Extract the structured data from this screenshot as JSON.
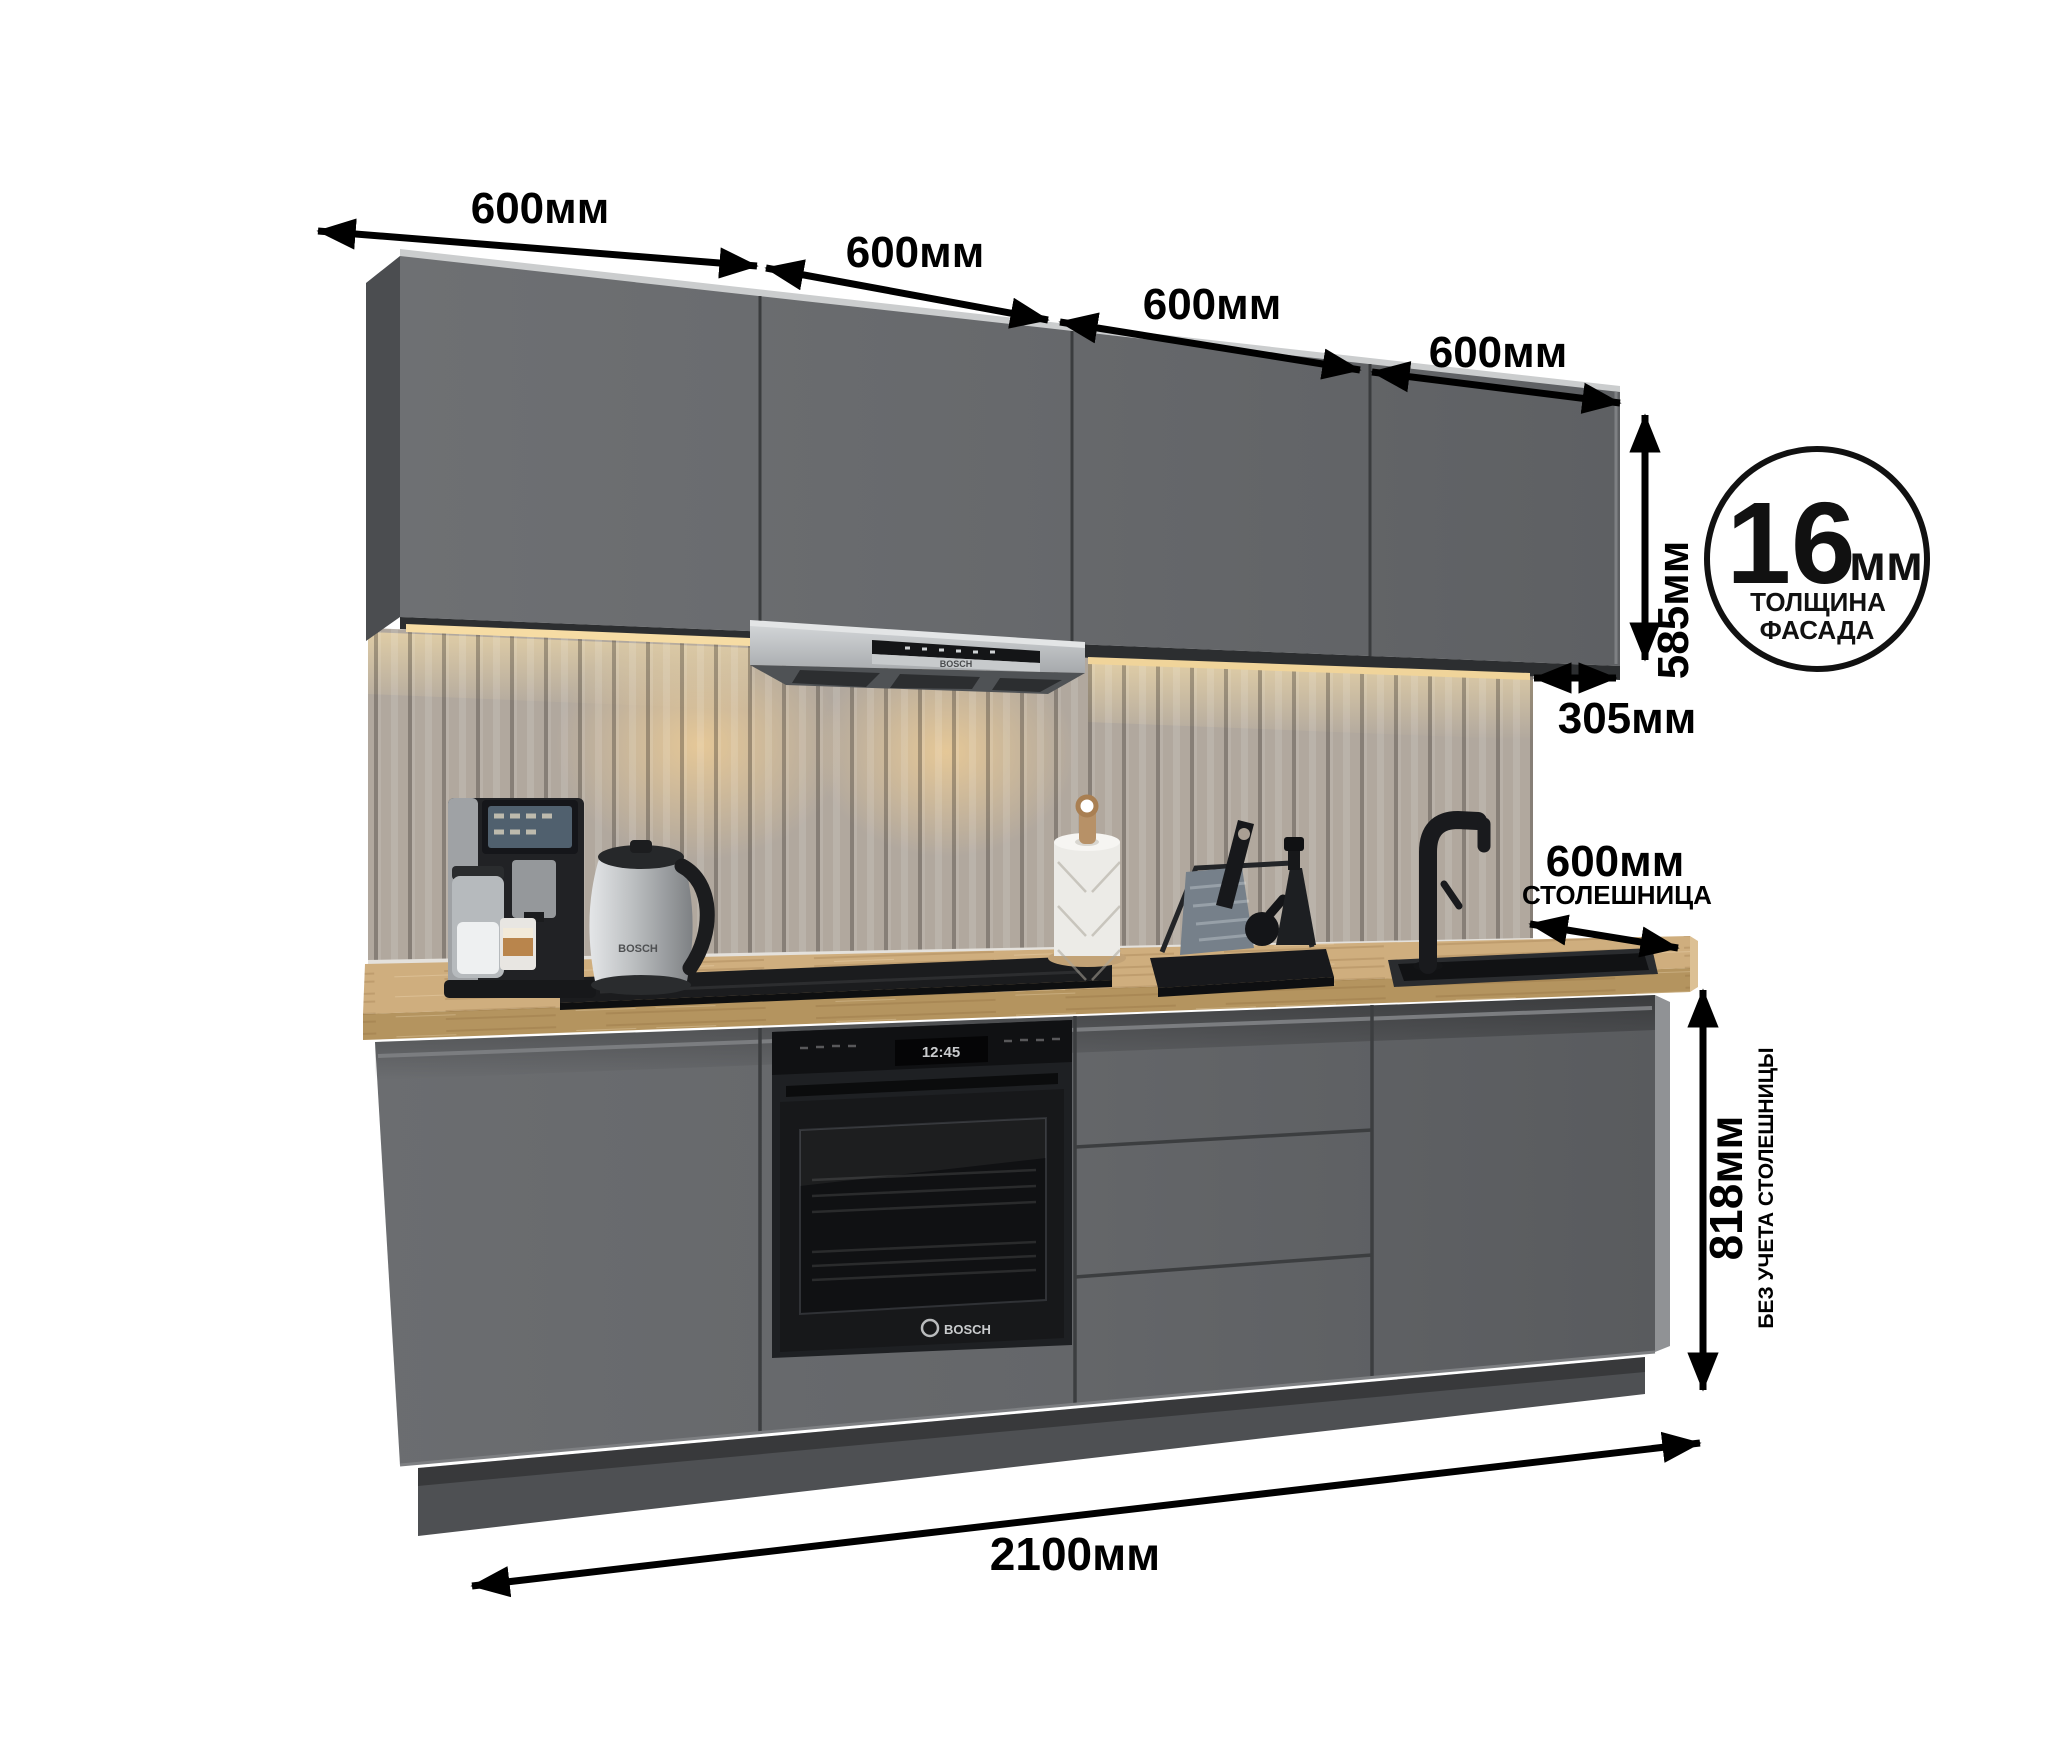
{
  "kitchen": {
    "dimensions": {
      "top_widths": [
        {
          "label": "600мм"
        },
        {
          "label": "600мм"
        },
        {
          "label": "600мм"
        },
        {
          "label": "600мм"
        }
      ],
      "upper_cabinet_height": {
        "label": "585мм"
      },
      "upper_cabinet_depth": {
        "label": "305мм"
      },
      "countertop_depth": {
        "label": "600мм",
        "sublabel": "СТОЛЕШНИЦА"
      },
      "base_height": {
        "label": "818мм",
        "sublabel": "БЕЗ УЧЕТА СТОЛЕШНИЦЫ"
      },
      "total_width": {
        "label": "2100мм"
      },
      "facade_thickness_badge": {
        "value": "16",
        "unit": "мм",
        "caption_line1": "ТОЛЩИНА",
        "caption_line2": "ФАСАДА"
      }
    },
    "appliances": {
      "hood_brand": "BOSCH",
      "oven_clock": "12:45",
      "oven_brand": "BOSCH",
      "kettle_brand": "BOSCH"
    },
    "colors": {
      "background": "#ffffff",
      "dimension_ink": "#000000",
      "cabinet_gray": "#67696c",
      "cabinet_side_dark": "#4b4d50",
      "toe_kick": "#4e5053",
      "countertop_wood": "#c9a97b",
      "backsplash": "#b1a89e",
      "led_warm": "#f3d9a4",
      "hood_steel": "#b9bcbe",
      "appliance_black": "#1b1c1e"
    }
  }
}
